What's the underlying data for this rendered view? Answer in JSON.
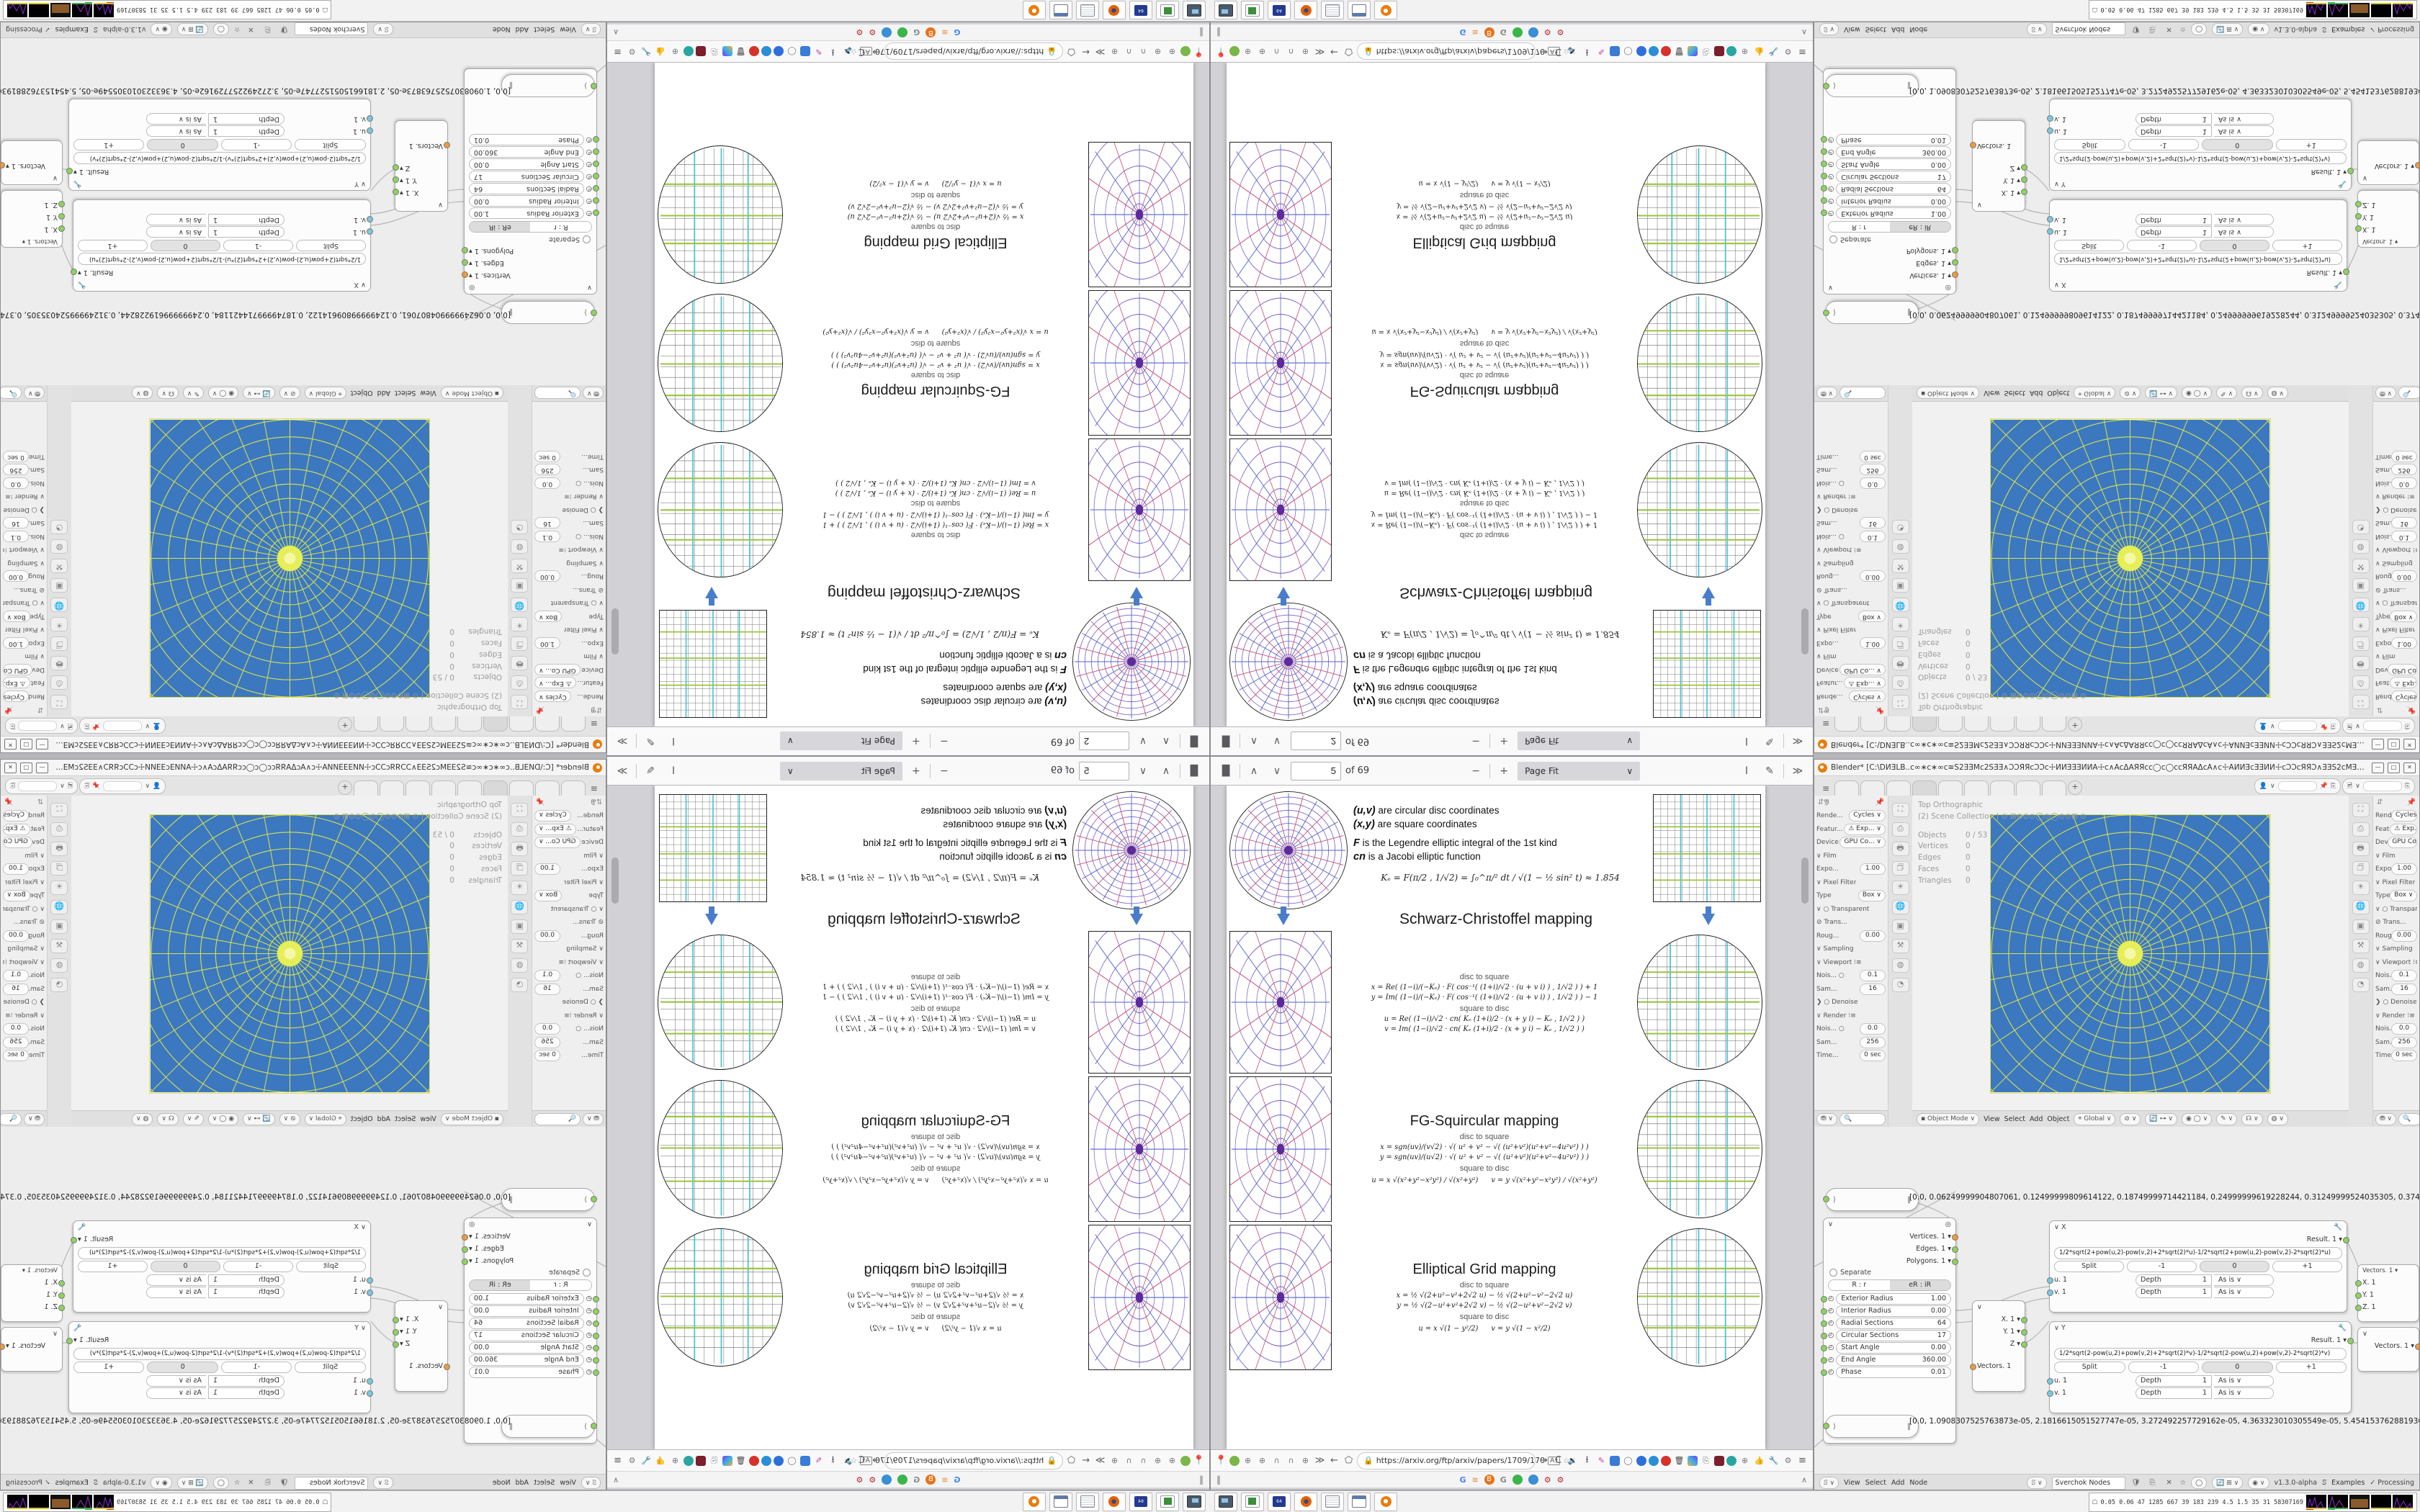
{
  "pdf": {
    "toolbar": {
      "page_top": "2",
      "page_bottom": "5",
      "of": "of 69",
      "zoom_select": "Page Fit",
      "chev": "∨"
    },
    "nav": {
      "url": "https://arxiv.org/ftp/arxiv/papers/1709/170"
    },
    "intro": {
      "l1b": "(u,v)",
      "l1": "are circular disc coordinates",
      "l2b": "(x,y)",
      "l2": "are square coordinates",
      "l3b": "F",
      "l3": "is the Legendre elliptic integral of the 1st kind",
      "l4b": "cn",
      "l4": "is a Jacobi elliptic function",
      "ke": "Kₑ = F(π∕2 , 1∕√2) = ∫₀^π∕² dt ∕ √(1 − ½ sin² t)  ≈ 1.854"
    },
    "sections": [
      {
        "title": "Schwarz-Christoffel mapping",
        "d2s": "disc to square",
        "s2d": "square to disc",
        "fx": "x = Re( (1−i)∕(−Kₑ) · F( cos⁻¹( (1+i)∕√2 · (u + v i) ) , 1∕√2 ) ) + 1",
        "fy": "y = Im( (1−i)∕(−Kₑ) · F( cos⁻¹( (1+i)∕√2 · (u + v i) ) , 1∕√2 ) ) − 1",
        "fu": "u = Re( (1−i)∕√2 · cn( Kₑ (1+i)∕2 · (x + y i) − Kₑ , 1∕√2 ) )",
        "fv": "v = Im( (1−i)∕√2 · cn( Kₑ (1+i)∕2 · (x + y i) − Kₑ , 1∕√2 ) )"
      },
      {
        "title": "FG-Squircular mapping",
        "d2s": "disc to square",
        "s2d": "square to disc",
        "fx": "x = sgn(uv)∕(v√2) · √( u² + v² − √( (u²+v²)(u²+v²−4u²v²) ) )",
        "fy": "y = sgn(uv)∕(u√2) · √( u² + v² − √( (u²+v²)(u²+v²−4u²v²) ) )",
        "fu": "u = x √(x²+y²−x²y²) ∕ √(x²+y²)",
        "fv": "v = y √(x²+y²−x²y²) ∕ √(x²+y²)"
      },
      {
        "title": "Elliptical Grid mapping",
        "d2s": "disc to square",
        "s2d": "square to disc",
        "fx": "x = ½ √(2+u²−v²+2√2 u)  −  ½ √(2+u²−v²−2√2 u)",
        "fy": "y = ½ √(2−u²+v²+2√2 v)  −  ½ √(2−u²+v²−2√2 v)",
        "fu": "u = x √(1 − y²∕2)",
        "fv": "v = y √(1 − x²∕2)"
      }
    ]
  },
  "browser": {
    "bm_left": "‖",
    "bm_right": "∧"
  },
  "taskbar": {
    "perf": "0.05 0.06  47  1285 667  39  183  239  4.5  1.5  35  31  58307169",
    "floppy": "64"
  },
  "blender": {
    "title": "Blender* [C:\\DИƎLB..ᴄ∞∗ᴄ∗∞ᴄ≊S2ƎƎMᴄ2SƎƎ∧ƆƆЯЯᴄƆƆᴄ☩ИИƎƎƎИИA☩ᴄ∧AᴄΔAЯЯᴄᴄ◯ᴄ◯ᴄᴄЯЯAΔᴄA∧ᴄ☩AИИƎᴄƎƎИИ☩ᴄƆƆᴄЯЯƆ∧ƎƎS2ᴄMƎƎS2≊ᴄ∞∗ᴄ∗∞...",
    "win": {
      "min": "—",
      "max": "□",
      "close": "✕"
    },
    "overlay": {
      "view": "Top Orthographic",
      "scene": "(2) Scene Collection |",
      "icons": "⊙ ⊞⊖⊙⊙◯⊙◯⊙⊙⊞ ⊙",
      "stats": [
        {
          "k": "Objects",
          "v": "0 / 53"
        },
        {
          "k": "Vertices",
          "v": "0"
        },
        {
          "k": "Edges",
          "v": "0"
        },
        {
          "k": "Faces",
          "v": "0"
        },
        {
          "k": "Triangles",
          "v": "0"
        }
      ]
    },
    "props": {
      "rows": [
        {
          "l": "Rende...",
          "v": "Cycles ∨"
        },
        {
          "l": "Featur...",
          "v": "⚠ Exp... ∨"
        },
        {
          "l": "Device",
          "v": "GPU Co... ∨"
        },
        {
          "l": "∨ Film",
          "v": ""
        },
        {
          "l": "Expo...",
          "v": "1.00"
        },
        {
          "l": "∨ Pixel Filter",
          "v": ""
        },
        {
          "l": "Type",
          "v": "Box ∨"
        },
        {
          "l": "∨ ○ Transparent",
          "v": ""
        },
        {
          "l": "⊘ Trans...",
          "v": ""
        },
        {
          "l": "Roug...",
          "v": "0.00"
        },
        {
          "l": "∨ Sampling",
          "v": ""
        },
        {
          "l": "∨ Viewport ⁝≡",
          "v": ""
        },
        {
          "l": "Nois... ○",
          "v": "0.1"
        },
        {
          "l": "Sam...",
          "v": "16"
        },
        {
          "l": "❯ ○ Denoise",
          "v": ""
        },
        {
          "l": "∨ Render ⁝≡",
          "v": ""
        },
        {
          "l": "Nois... ○",
          "v": "0.0"
        },
        {
          "l": "Sam...",
          "v": "256"
        },
        {
          "l": "Time...",
          "v": "0 sec"
        }
      ]
    },
    "vph": {
      "mode": "▪ Object Mode ∨",
      "view": "View",
      "select": "Select",
      "add": "Add",
      "object": "Object",
      "orient": "⌖ Global ∨",
      "i1": "⊘ ∨",
      "i2": "🔄 ⊶ ∨",
      "i3": "◉ ◯ ∨",
      "i4": "✎ ∨",
      "i5": "☊ ∨",
      "i6": "◍ ∨"
    },
    "ne": {
      "view": "View",
      "select": "Select",
      "add": "Add",
      "node": "Node",
      "tree": "Sverchok Nodes",
      "version": "v1.3.0-alpha",
      "examples": "Examples",
      "processing": "✓  Processing",
      "circle": {
        "outs": [
          {
            "t": "Vertices. 1 ▾"
          },
          {
            "t": "Edges. 1 ▾"
          },
          {
            "t": "Polygons. 1 ▾"
          }
        ],
        "separate": "Separate",
        "m1": "R : r",
        "m2": "eR : iR",
        "fields": [
          {
            "l": "Exterior Radius",
            "v": "1.00"
          },
          {
            "l": "Interior Radius",
            "v": "0.00"
          },
          {
            "l": "Radial Sections",
            "v": "64"
          },
          {
            "l": "Circular Sections",
            "v": "17"
          },
          {
            "l": "Start Angle",
            "v": "0.00"
          },
          {
            "l": "End Angle",
            "v": "360.00"
          },
          {
            "l": "Phase",
            "v": "0.01"
          }
        ]
      },
      "xnode": {
        "t": "∨ X",
        "result": "Result. 1 ▾",
        "formula": "1/2*sqrt(2+pow(u,2)-pow(v,2)+2*sqrt(2)*u)-1/2*sqrt(2+pow(u,2)-pow(v,2)-2*sqrt(2)*u)",
        "split": "Split",
        "bm": "-1",
        "bz": "0",
        "bp": "+1",
        "u": "u. 1",
        "v": "v. 1",
        "depth": "Depth",
        "one": "1",
        "asis": "As is ∨"
      },
      "ynode": {
        "t": "∨ Y",
        "result": "Result. 1 ▾",
        "formula": "1/2*sqrt(2-pow(u,2)+pow(v,2)+2*sqrt(2)*v)-1/2*sqrt(2-pow(u,2)+pow(v,2)-2*sqrt(2)*v)",
        "split": "Split",
        "bm": "-1",
        "bz": "0",
        "bp": "+1",
        "u": "u. 1",
        "v": "v. 1",
        "depth": "Depth",
        "one": "1",
        "asis": "As is ∨"
      },
      "vout": {
        "h": "Vectors. 1 ▾",
        "rows": [
          {
            "t": "X. 1"
          },
          {
            "t": "Y. 1"
          },
          {
            "t": "Z. 1"
          }
        ]
      },
      "vin": {
        "h": "∨",
        "rows": [
          {
            "t": "X. 1 ▾"
          },
          {
            "t": "Y. 1 ▾"
          },
          {
            "t": "Z ▾"
          }
        ],
        "out": "Vectors. 1"
      },
      "vin2": {
        "h": "∨",
        "out": "Vectors. 1 ▾"
      },
      "s1": "[0.0, 0.06249999904807061, 0.12499999809614122, 0.18749999714421184, 0.24999999619228244, 0.31249999524035305, 0.374",
      "s2": "[0.0, 1.0908307525763873e-05, 2.1816615051527747e-05, 3.272492257729162e-05, 4.363323010305549e-05, 5.454153762881936"
    }
  }
}
